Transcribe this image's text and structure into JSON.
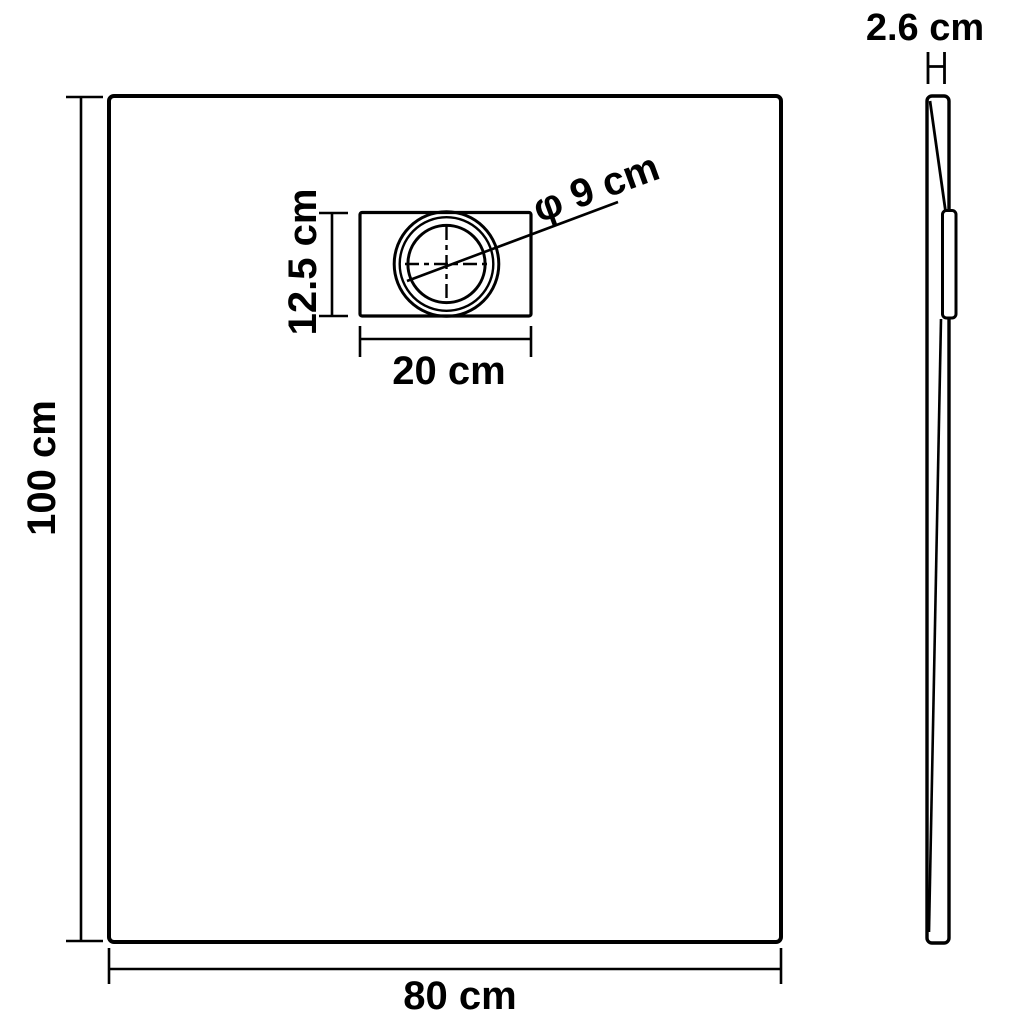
{
  "labels": {
    "front_height": "100 cm",
    "front_width": "80 cm",
    "drain_box_height": "12.5 cm",
    "drain_box_width": "20 cm",
    "drain_diameter": "φ 9 cm",
    "side_thickness": "2.6 cm"
  },
  "colors": {
    "line": "#000000",
    "background": "#ffffff"
  }
}
